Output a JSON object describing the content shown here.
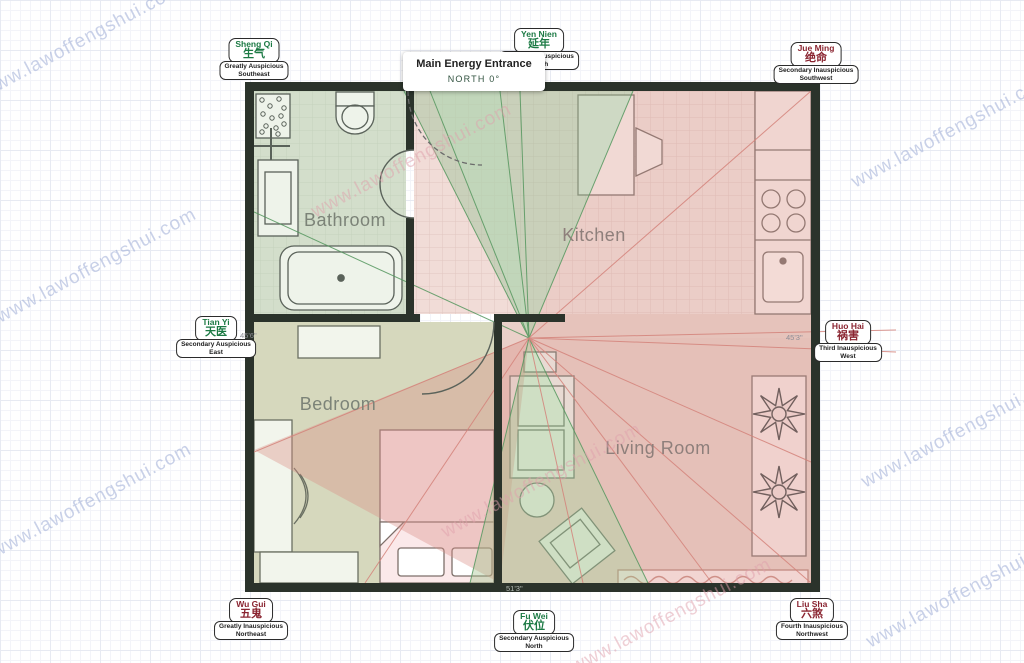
{
  "watermark": {
    "text": "www.lawoffengshui.com"
  },
  "entrance_tooltip": {
    "title": "Main Energy Entrance",
    "direction": "NORTH 0°"
  },
  "rooms": [
    {
      "name": "Bathroom"
    },
    {
      "name": "Kitchen"
    },
    {
      "name": "Bedroom"
    },
    {
      "name": "Living Room"
    }
  ],
  "dimensions": {
    "left": "45'6\"",
    "right": "45'3\"",
    "bottom": "51'3\""
  },
  "compass_labels": [
    {
      "id": "sheng-qi",
      "name": "Sheng Qi",
      "hanzi": "生气",
      "classification": "Greatly Auspicious",
      "direction": "Southeast",
      "type": "auspicious"
    },
    {
      "id": "yen-nien",
      "name": "Yen Nien",
      "hanzi": "延年",
      "classification": "Secondary Auspicious",
      "direction": "South",
      "type": "auspicious"
    },
    {
      "id": "jue-ming",
      "name": "Jue Ming",
      "hanzi": "绝命",
      "classification": "Secondary Inauspicious",
      "direction": "Southwest",
      "type": "inauspicious"
    },
    {
      "id": "tian-yi",
      "name": "Tian Yi",
      "hanzi": "天医",
      "classification": "Secondary Auspicious",
      "direction": "East",
      "type": "auspicious"
    },
    {
      "id": "huo-hai",
      "name": "Huo Hai",
      "hanzi": "祸害",
      "classification": "Third Inauspicious",
      "direction": "West",
      "type": "inauspicious"
    },
    {
      "id": "wu-gui",
      "name": "Wu Gui",
      "hanzi": "五鬼",
      "classification": "Greatly Inauspicious",
      "direction": "Northeast",
      "type": "inauspicious"
    },
    {
      "id": "fu-wei",
      "name": "Fu Wei",
      "hanzi": "伏位",
      "classification": "Secondary Auspicious",
      "direction": "North",
      "type": "auspicious"
    },
    {
      "id": "liu-sha",
      "name": "Liu Sha",
      "hanzi": "六煞",
      "classification": "Fourth Inauspicious",
      "direction": "Northwest",
      "type": "inauspicious"
    }
  ],
  "colors": {
    "auspicious_text": "#1c7a44",
    "inauspicious_text": "#8a2430",
    "wall": "#2b332b",
    "green_sector": "#8fbe8f",
    "red_sector": "#d98f86",
    "bathroom_fill": "#d3decb",
    "kitchen_fill": "#f1dcd7",
    "bedroom_fill": "#d6d8bd",
    "living_fill": "#ead0c9"
  }
}
